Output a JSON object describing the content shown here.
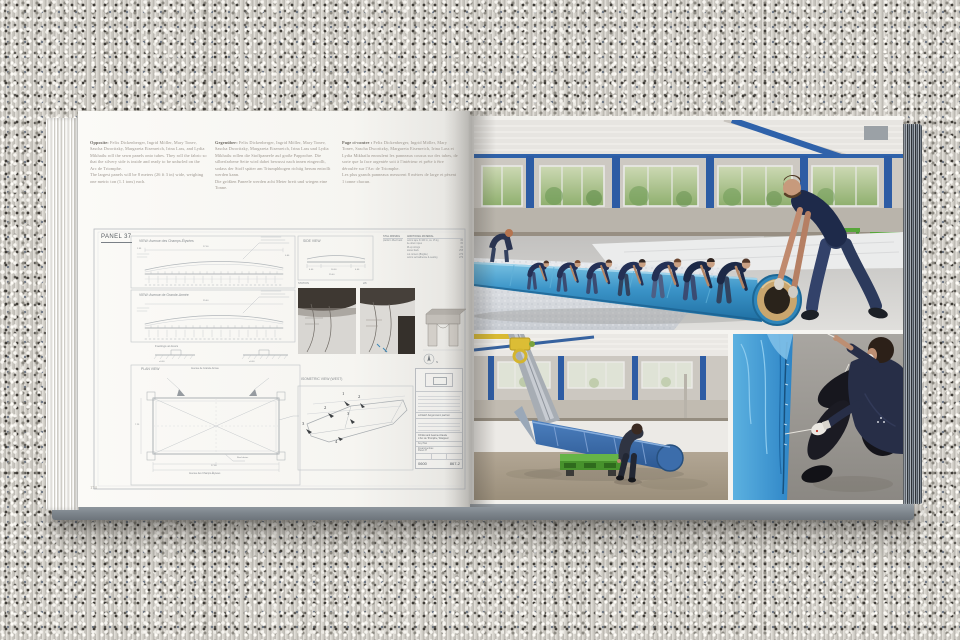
{
  "palette": {
    "fabric_blue": "#3d9ad1",
    "roll_core_tan": "#c9a66e",
    "pallet_green": "#55a434",
    "steel_blue": "#2d5ca4",
    "crane_yellow": "#dcbd35",
    "cover_edge_gray": "#8d969d",
    "worker_navy": "#1e2a4a",
    "silver_fabric": "#dfe1e5"
  },
  "book": {
    "left_page": {
      "page_number": "174",
      "captions": [
        {
          "lang": "en",
          "lead": "Opposite:",
          "body": "Felix Dickenberger, Ingrid Möller, Mary Tonev, Sascha Dworitzky, Margareta Eisenreich, Irina Lass, and Lydia Mikhailu roll the sewn panels onto tubes. They roll the fabric so that the silvery side is inside and ready to be unfurled on the Arc de Triomphe.\nThe largest panels will be 8 meters (26 ft 3 in) wide, weighing one metric ton (1.1 tons) each."
        },
        {
          "lang": "de",
          "lead": "Gegenüber:",
          "body": "Felix Dickenberger, Ingrid Möller, Mary Tonev, Sascha Dworitzky, Margareta Eisenreich, Irina Lass und Lydia Mikhailu rollen die Stoffpaneele auf große Papprohre. Die silberfarbene Seite wird dabei bewusst nach innen eingerollt, sodass der Stoff später am Triumphbogen richtig herum entrollt werden kann.\nDie größten Paneele werden acht Meter breit und wiegen eine Tonne."
        },
        {
          "lang": "fr",
          "lead": "Page ci-contre :",
          "body": "Felix Dickenberger, Ingrid Möller, Mary Tonev, Sascha Dworitzky, Margareta Eisenreich, Irina Lass et Lydia Mikhailu enroulent les panneaux cousus sur des tubes, de sorte que la face argentée soit à l'intérieur et prête à être déroulée sur l'Arc de Triomphe.\nLes plus grands panneaux mesurent 8 mètres de large et pèsent 1 tonne chacun."
        }
      ],
      "drawing": {
        "panel_label": "PANEL 37",
        "view_champs": "VIEW:  Avenue des Champs-Élysées",
        "view_grande": "VIEW:  Avenue de Grande-Armée",
        "side_view": "SIDE VIEW",
        "plan_view": "PLAN VIEW",
        "footings": "Footings at doors",
        "iso_view": "ISOMETRIC VIEW (WEST)",
        "station": "STATION",
        "sheet_scale": "2/6",
        "plan_top": "Avenue de Grande-Armée",
        "plan_bottom": "Avenue des Champs-Élysées",
        "roof_drains": "Roof drains",
        "north": "N",
        "materials": {
          "col1_header": "STILL MISSING",
          "col1_row": "platform lifted back",
          "col2_header": "ADDITIONAL MATERIAL",
          "rows": [
            {
              "item": "velcro tape 3×100 m, ca. 15 kg",
              "qty": "80"
            },
            {
              "item": "tie-down ropes",
              "qty": "80"
            },
            {
              "item": "lift-up strings",
              "qty": "80"
            },
            {
              "item": "swivel back",
              "qty": "258"
            },
            {
              "item": "cut corners (Brigitte)",
              "qty": "279"
            },
            {
              "item": "velcro self-adhesive & sealing",
              "qty": "279"
            }
          ]
        },
        "title_block": {
          "engineer": "schlaich bergermann partner",
          "client1": "Christo and Jeanne-Claude",
          "client2": "L'Arc de Triomphe, Wrapped",
          "key_plan": "Key Plan",
          "title": "Zusammenbau",
          "panel": "Panel 37",
          "num_left": "0600",
          "num_right": "867-2"
        },
        "dims": {
          "w_top": "27.00",
          "w_mid": "25.40",
          "seg": "2.55",
          "edge": "0.60",
          "side_a": "4.00",
          "side_b": "16.00",
          "level": "±0.00",
          "plan_w": "27.00",
          "plan_h": "7.25"
        },
        "iso_numbers": [
          "1",
          "2",
          "2",
          "3",
          "3",
          "4",
          "4"
        ]
      }
    }
  }
}
